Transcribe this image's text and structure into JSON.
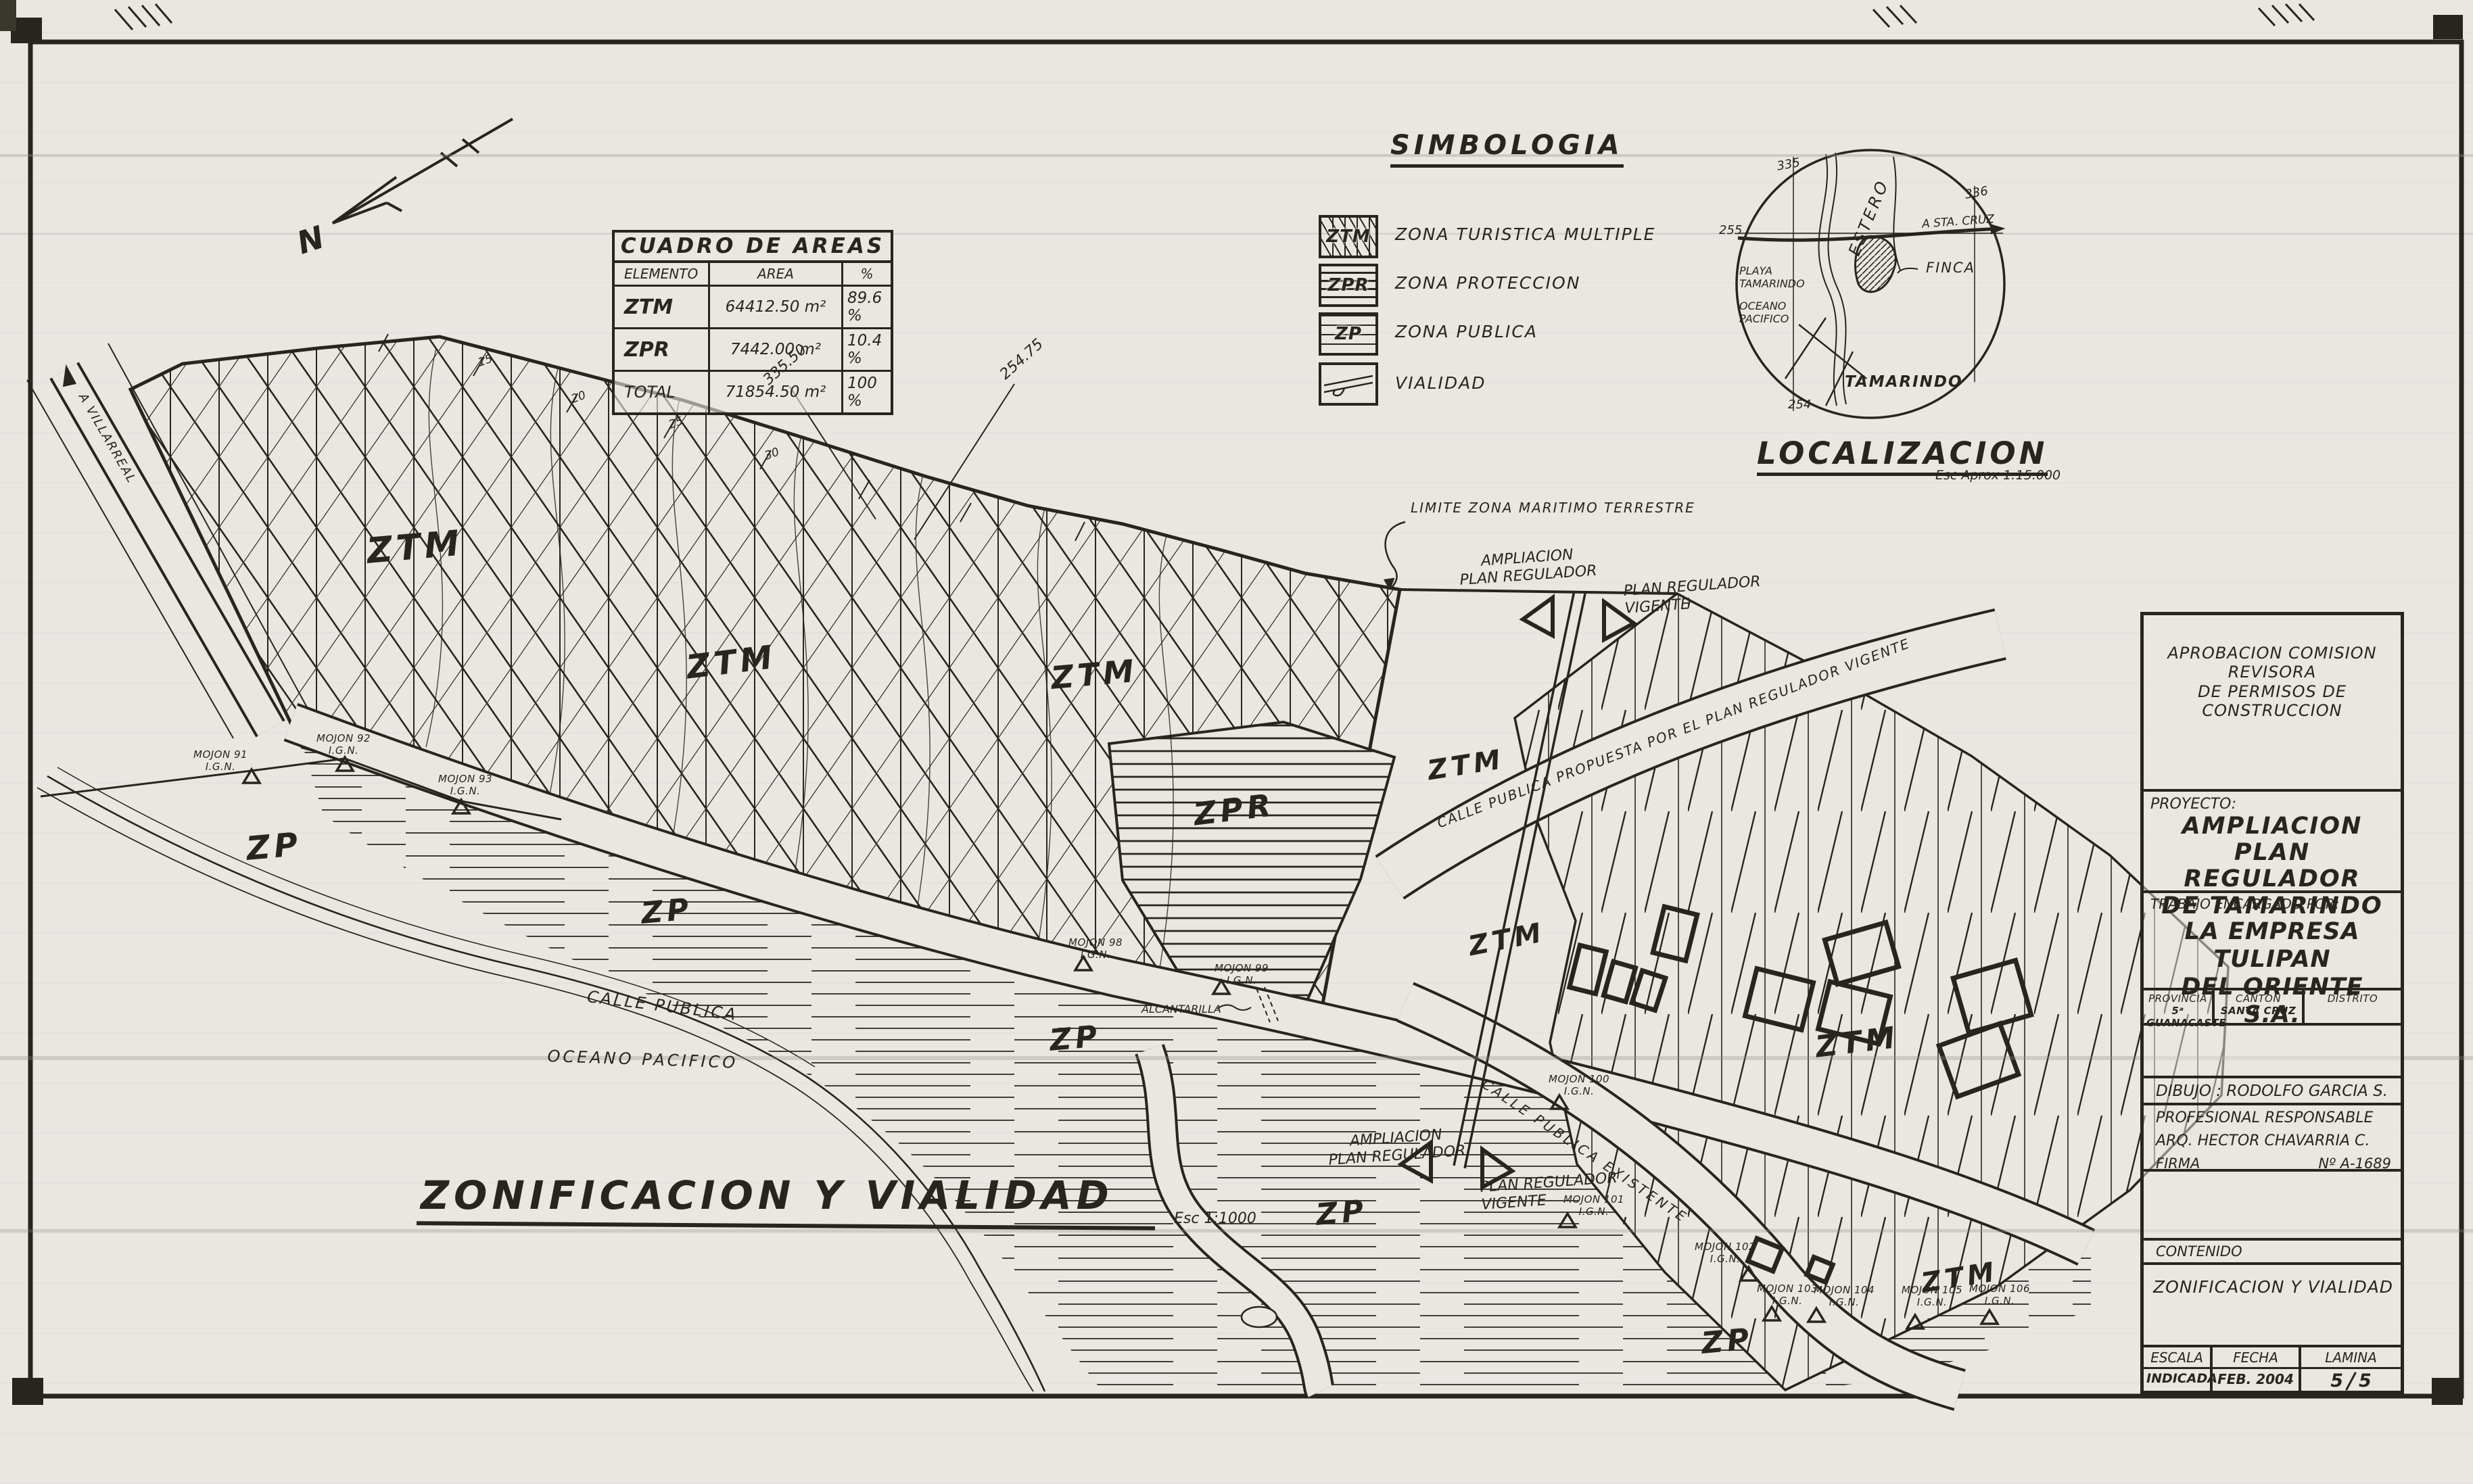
{
  "title_block": {
    "approval": "APROBACION COMISION REVISORA\nDE PERMISOS DE CONSTRUCCION",
    "proyecto_label": "PROYECTO:",
    "proyecto": "AMPLIACION\nPLAN REGULADOR\nDE TAMARINDO",
    "trabajo_label": "TRABAJO ENCARGADO POR:",
    "cliente": "LA EMPRESA TULIPAN\nDEL ORIENTE S.A.",
    "provincia_label": "PROVINCIA",
    "provincia": "5ᵃ GUANACASTE",
    "canton_label": "CANTON",
    "canton": "SANTA CRUZ",
    "distrito_label": "DISTRITO",
    "distrito": "",
    "dibujo": "DIBUJO : RODOLFO GARCIA S.",
    "profesional_label": "PROFESIONAL RESPONSABLE",
    "profesional": "ARQ. HECTOR CHAVARRIA C.",
    "firma_label": "FIRMA",
    "registro": "Nº A-1689",
    "contenido_label": "CONTENIDO",
    "contenido": "ZONIFICACION Y VIALIDAD",
    "escala_label": "ESCALA",
    "escala": "INDICADA",
    "fecha_label": "FECHA",
    "fecha": "FEB. 2004",
    "lamina_label": "LAMINA",
    "lamina_sheet": "5",
    "lamina_total": "5"
  },
  "areas_table": {
    "title": "CUADRO DE AREAS",
    "headers": {
      "elemento": "ELEMENTO",
      "area": "AREA",
      "pct": "%"
    },
    "rows": [
      {
        "elemento": "ZTM",
        "area": "64412.50 m²",
        "pct": "89.6 %"
      },
      {
        "elemento": "ZPR",
        "area": "7442.00 m²",
        "pct": "10.4 %"
      },
      {
        "elemento": "TOTAL",
        "area": "71854.50 m²",
        "pct": "100 %"
      }
    ]
  },
  "legend": {
    "title": "SIMBOLOGIA",
    "items": [
      {
        "code": "ZTM",
        "label": "ZONA TURISTICA MULTIPLE"
      },
      {
        "code": "ZPR",
        "label": "ZONA PROTECCION"
      },
      {
        "code": "ZP",
        "label": "ZONA PUBLICA"
      },
      {
        "code": "",
        "label": "VIALIDAD"
      }
    ]
  },
  "localizacion": {
    "title": "LOCALIZACION",
    "scale_note": "Esc Aprox 1:15.000",
    "labels": {
      "estero": "ESTERO",
      "sta_cruz": "A STA. CRUZ",
      "playa": "PLAYA\nTAMARINDO",
      "oceano": "OCEANO\nPACIFICO",
      "finca": "FINCA",
      "tamarindo": "TAMARINDO"
    },
    "grid": {
      "nw": "335",
      "ne": "336",
      "w": "255",
      "s": "254"
    }
  },
  "map": {
    "drawing_title": "ZONIFICACION Y VIALIDAD",
    "drawing_scale": "Esc  1:1000",
    "compass": "N",
    "codes": {
      "ztm": "ZTM",
      "zpr": "ZPR",
      "zp": "ZP"
    },
    "roads": {
      "calle_publica": "CALLE PUBLICA",
      "propuesta": "CALLE PUBLICA PROPUESTA POR EL PLAN REGULADOR VIGENTE",
      "existente": "CALLE PUBLICA EXISTENTE",
      "villarreal": "A VILLARREAL"
    },
    "notes": {
      "limite": "LIMITE ZONA MARITIMO TERRESTRE",
      "alcantarilla": "ALCANTARILLA",
      "oceano": "OCEANO PACIFICO"
    },
    "markers": {
      "ampliacion": "AMPLIACION\nPLAN REGULADOR",
      "vigente": "PLAN REGULADOR\nVIGENTE"
    },
    "dims": {
      "d1": "335.50",
      "d2": "254.75"
    },
    "contours": [
      "15",
      "20",
      "25",
      "30"
    ],
    "ign": "I.G.N.",
    "mojones": [
      "MOJON 91",
      "MOJON 92",
      "MOJON 93",
      "MOJON 98",
      "MOJON 99",
      "MOJON 100",
      "MOJON 101",
      "MOJON 102",
      "MOJON 103",
      "MOJON 104",
      "MOJON 105",
      "MOJON 106"
    ]
  }
}
